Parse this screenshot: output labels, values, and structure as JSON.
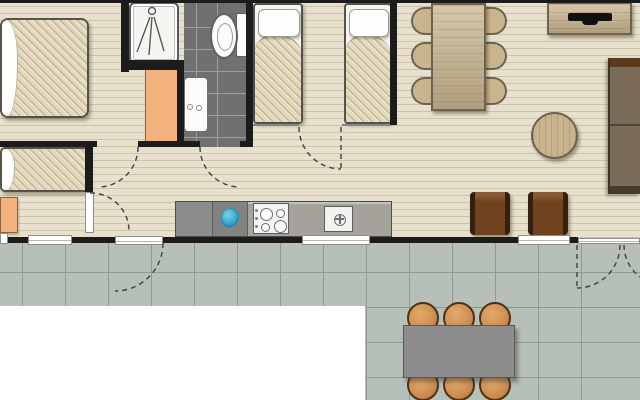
{
  "plan": {
    "colors": {
      "wall": "#1c1c1c",
      "floor": "#e7e0cd",
      "floor_line": "#cdc3aa",
      "deck_tile": "#b6c0b8",
      "deck_grout": "#8e9b93",
      "bath_tile": "#707070",
      "bath_grout": "#9d9d9d",
      "counter": "#a5a29c",
      "orange": "#f3b17d",
      "wood": "#c8b48e",
      "wood_edge": "#6e6250",
      "sofa": "#7b6b59",
      "sofa_trim": "#5e3a1e",
      "chair": "#6f431f",
      "chair_arm": "#35200f",
      "stool": "#cd8d52",
      "out_table": "#8d8d8d",
      "sink_blue": "#35a7cd"
    },
    "symbols": {
      "double_bed": "bedroom top-left",
      "single_beds": 2,
      "small_bed": "bedroom bottom-left",
      "shower_icon": "shower cubicle with spray symbol",
      "toilet_icon": "toilet with cistern",
      "basin_icon": "washbasin with taps",
      "dining_chairs": 6,
      "deck_stools": 6,
      "armchairs": 2,
      "sofa_seats": 2,
      "tv_icon": "flat tv on sideboard",
      "cooktop_burners": 4,
      "sink_drain_icon": "circled cross",
      "door_swings": 7,
      "windows": 3
    }
  }
}
